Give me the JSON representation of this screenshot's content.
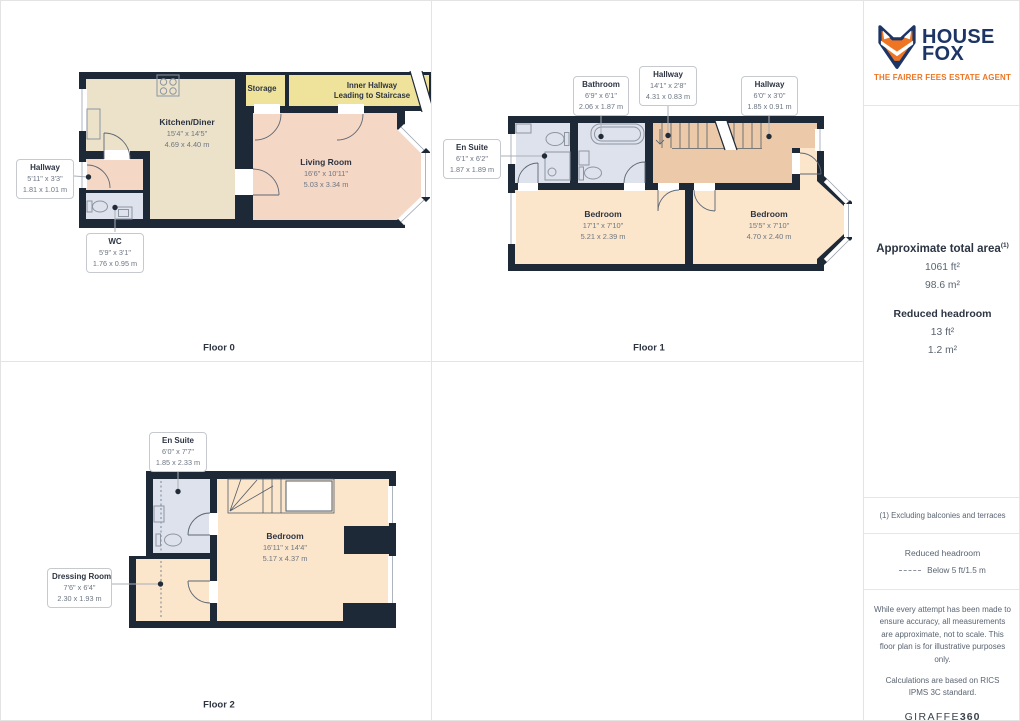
{
  "branding": {
    "name_line1": "HOUSE",
    "name_line2": "FOX",
    "tagline": "THE FAIRER FEES ESTATE AGENT",
    "navy": "#1c3566",
    "orange": "#ed7523"
  },
  "sidebar": {
    "total_area": {
      "heading": "Approximate total area",
      "footnote_marker": "(1)",
      "imperial": "1061 ft²",
      "metric": "98.6 m²"
    },
    "reduced_headroom": {
      "heading": "Reduced headroom",
      "imperial": "13 ft²",
      "metric": "1.2 m²"
    },
    "footnote": "(1) Excluding balconies and terraces",
    "legend": {
      "heading": "Reduced headroom",
      "label": "Below 5 ft/1.5 m"
    },
    "disclaimer1": "While every attempt has been made to ensure accuracy, all measurements are approximate, not to scale. This floor plan is for illustrative purposes only.",
    "disclaimer2": "Calculations are based on RICS IPMS 3C standard.",
    "provider_name": "GIRAFFE",
    "provider_suffix": "360"
  },
  "floors": [
    {
      "label": "Floor 0",
      "rooms": [
        {
          "name": "Kitchen/Diner",
          "imperial": "15'4\" x 14'5\"",
          "metric": "4.69 x 4.40 m"
        },
        {
          "name": "Living Room",
          "imperial": "16'6\" x 10'11\"",
          "metric": "5.03 x 3.34 m"
        },
        {
          "name": "Storage"
        },
        {
          "name": "Inner Hallway",
          "note": "Leading to Staircase"
        },
        {
          "name": "Hallway",
          "imperial": "5'11\" x 3'3\"",
          "metric": "1.81 x 1.01 m"
        },
        {
          "name": "WC",
          "imperial": "5'9\" x 3'1\"",
          "metric": "1.76 x 0.95 m"
        }
      ]
    },
    {
      "label": "Floor 1",
      "rooms": [
        {
          "name": "Bathroom",
          "imperial": "6'9\" x 6'1\"",
          "metric": "2.06 x 1.87 m"
        },
        {
          "name": "Hallway",
          "imperial": "14'1\" x 2'8\"",
          "metric": "4.31 x 0.83 m"
        },
        {
          "name": "Hallway",
          "imperial": "6'0\" x 3'0\"",
          "metric": "1.85 x 0.91 m"
        },
        {
          "name": "En Suite",
          "imperial": "6'1\" x 6'2\"",
          "metric": "1.87 x 1.89 m"
        },
        {
          "name": "Bedroom",
          "imperial": "17'1\" x 7'10\"",
          "metric": "5.21 x 2.39 m"
        },
        {
          "name": "Bedroom",
          "imperial": "15'5\" x 7'10\"",
          "metric": "4.70 x 2.40 m"
        }
      ]
    },
    {
      "label": "Floor 2",
      "rooms": [
        {
          "name": "En Suite",
          "imperial": "6'0\" x 7'7\"",
          "metric": "1.85 x 2.33 m"
        },
        {
          "name": "Dressing Room",
          "imperial": "7'6\" x 6'4\"",
          "metric": "2.30 x 1.93 m"
        },
        {
          "name": "Bedroom",
          "imperial": "16'11\" x 14'4\"",
          "metric": "5.17 x 4.37 m"
        }
      ]
    }
  ],
  "colors": {
    "wall": "#1e2937",
    "kitchen": "#ece2ca",
    "hallway_yellow": "#efe39b",
    "living_pink": "#f5d7c5",
    "landing_tan": "#eccaa9",
    "bedroom_peach": "#fbe5cb",
    "bathroom_blue": "#dee2ed"
  }
}
